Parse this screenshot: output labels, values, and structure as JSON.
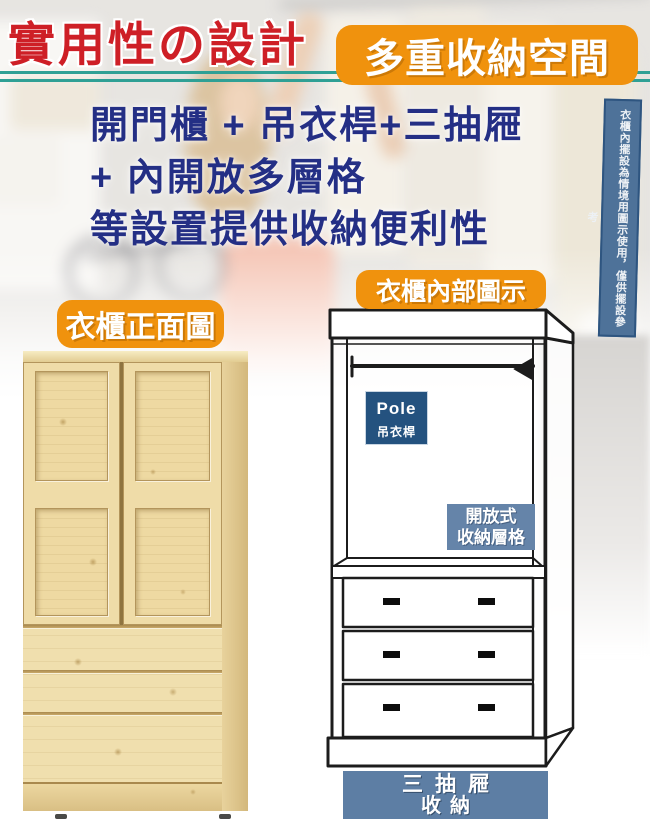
{
  "header": {
    "title": "實用性の設計",
    "badge": "多重收納空間"
  },
  "headline": {
    "line1": "開門櫃 + 吊衣桿+三抽屜",
    "line2": "+ 內開放多層格",
    "line3": "等設置提供收納便利性"
  },
  "disclaimer": "衣櫃內擺設為情境用圖示使用，僅供擺設參考",
  "front_view": {
    "badge": "衣櫃正面圖"
  },
  "interior_view": {
    "badge": "衣櫃內部圖示",
    "pole_label": {
      "en": "Pole",
      "zh": "吊衣桿"
    },
    "shelf_label": {
      "line1": "開放式",
      "line2": "收納層格"
    },
    "drawers_label": {
      "line1": "三抽屜",
      "line2": "收納"
    }
  },
  "colors": {
    "title_red": "#ce1f26",
    "badge_orange": "#f0920d",
    "headline_blue": "#242f85",
    "teal_line": "#2fa095",
    "pole_label_navy": "#24527f",
    "shelf_label_slate": "#6584a9",
    "drawers_label_slate": "#5d7ea4",
    "disclaimer_bg": "#4e7299",
    "wood_light": "#f0dfae",
    "wood_dark": "#d9bf84"
  }
}
